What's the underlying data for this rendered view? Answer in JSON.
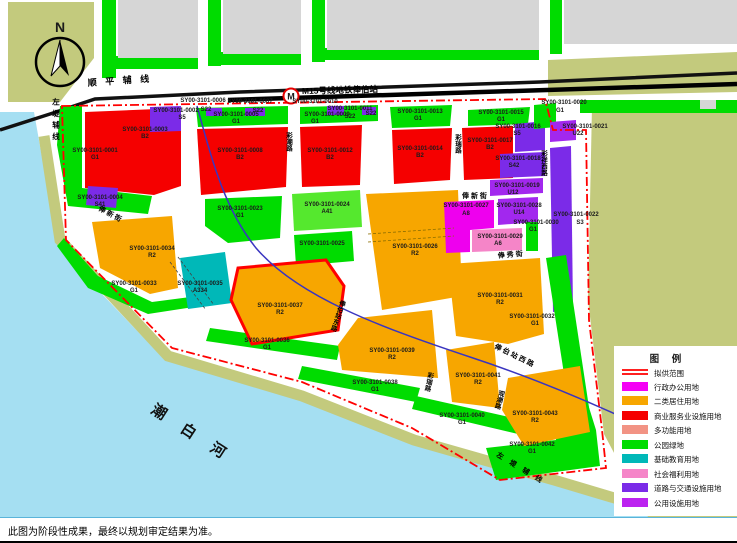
{
  "compass": {
    "label": "N"
  },
  "station": {
    "symbol": "M",
    "label": "M15号线地铁俸伯站"
  },
  "streets": {
    "shunping": "顺 平 辅 线",
    "zuodi_top": "左堤辅线",
    "zuodi_bottom": "左 堤 辅 线",
    "river": "潮 白 河",
    "fengxin_left": "俸 新 街",
    "fengxin_right": "俸 新 街",
    "fengxiu": "俸 秀 街",
    "caichao": "彩潮路",
    "cairui_north": "彩瑞路",
    "cairui_south": "彩瑞路",
    "caixiang_west": "彩祥西路",
    "guanchao": "观潮路",
    "fengbo_east": "俸伯站东路",
    "fengbo_west": "俸 伯 站 西 路"
  },
  "colors": {
    "G1": "#00DC00",
    "B2": "#F50000",
    "R2": "#F7A600",
    "S": "#7B2BE8",
    "U": "#A228EE",
    "A8": "#EE00EE",
    "A6": "#F585C8",
    "A41": "#55E82E",
    "A33": "#00B8B8",
    "water": "#A5DFF2",
    "olive": "#C3CA7D",
    "gray": "#D6D6D6",
    "boundary": "#FF0000",
    "metro_line": "#3A35C0"
  },
  "parcels": [
    {
      "code": "SY00-3101-0001",
      "type": "G1"
    },
    {
      "code": "SY00-3101-0002",
      "type": "S5"
    },
    {
      "code": "SY00-3101-0003",
      "type": "B2"
    },
    {
      "code": "SY00-3101-0004",
      "type": "S41"
    },
    {
      "code": "SY00-3101-0005",
      "type": "G1"
    },
    {
      "code": "SY00-3101-0006",
      "type": ""
    },
    {
      "code": "SY00-3101-0007",
      "type": ""
    },
    {
      "code": "SY00-3101-0008",
      "type": "B2"
    },
    {
      "code": "SY00-3101-0009",
      "type": "G1"
    },
    {
      "code": "SY00-3101-0010",
      "type": ""
    },
    {
      "code": "SY00-3101-0011",
      "type": "S22"
    },
    {
      "code": "SY00-3101-0012",
      "type": "B2"
    },
    {
      "code": "SY00-3101-0013",
      "type": "G1"
    },
    {
      "code": "SY00-3101-0014",
      "type": "B2"
    },
    {
      "code": "SY00-3101-0015",
      "type": "G1"
    },
    {
      "code": "SY00-3101-0016",
      "type": "S5"
    },
    {
      "code": "SY00-3101-0017",
      "type": "B2"
    },
    {
      "code": "SY00-3101-0018",
      "type": "S42"
    },
    {
      "code": "SY00-3101-0019",
      "type": "U12"
    },
    {
      "code": "SY00-3101-0020",
      "type": "G1"
    },
    {
      "code": "SY00-3101-0021",
      "type": "U22"
    },
    {
      "code": "SY00-3101-0022",
      "type": "S3"
    },
    {
      "code": "SY00-3101-0023",
      "type": "G1"
    },
    {
      "code": "SY00-3101-0024",
      "type": "A41"
    },
    {
      "code": "SY00-3101-0025",
      "type": ""
    },
    {
      "code": "SY00-3101-0026",
      "type": "R2"
    },
    {
      "code": "SY00-3101-0027",
      "type": "A8"
    },
    {
      "code": "SY00-3101-0028",
      "type": "U14"
    },
    {
      "code": "SY00-3101-0029",
      "type": "A6"
    },
    {
      "code": "SY00-3101-0030",
      "type": "G1"
    },
    {
      "code": "SY00-3101-0031",
      "type": "R2"
    },
    {
      "code": "SY00-3101-0032",
      "type": "G1"
    },
    {
      "code": "SY00-3101-0033",
      "type": "G1"
    },
    {
      "code": "SY00-3101-0034",
      "type": "R2"
    },
    {
      "code": "SY00-3101-0035",
      "type": "A334"
    },
    {
      "code": "SY00-3101-0036",
      "type": "G1"
    },
    {
      "code": "SY00-3101-0037",
      "type": "R2"
    },
    {
      "code": "SY00-3101-0038",
      "type": "G1"
    },
    {
      "code": "SY00-3101-0039",
      "type": "R2"
    },
    {
      "code": "SY00-3101-0040",
      "type": "G1"
    },
    {
      "code": "SY00-3101-0041",
      "type": "R2"
    },
    {
      "code": "SY00-3101-0042",
      "type": "G1"
    },
    {
      "code": "SY00-3101-0043",
      "type": "R2"
    }
  ],
  "extra_labels": {
    "s22_a": "S22",
    "s22_b": "S22",
    "s22_c": "S22"
  },
  "legend": {
    "title": "图  例",
    "items": [
      {
        "label": "拟供范围",
        "color": "#FF0000"
      },
      {
        "label": "行政办公用地",
        "color": "#F500F5"
      },
      {
        "label": "二类居住用地",
        "color": "#F7A600"
      },
      {
        "label": "商业服务业设施用地",
        "color": "#F50000"
      },
      {
        "label": "多功能用地",
        "color": "#F29384"
      },
      {
        "label": "公园绿地",
        "color": "#00DC00"
      },
      {
        "label": "基础教育用地",
        "color": "#00B8B8"
      },
      {
        "label": "社会福利用地",
        "color": "#F585C8"
      },
      {
        "label": "道路与交通设施用地",
        "color": "#7B2BE8"
      },
      {
        "label": "公用设施用地",
        "color": "#BC23F0"
      }
    ]
  },
  "note": "此图为阶段性成果，最终以规划审定结果为准。"
}
